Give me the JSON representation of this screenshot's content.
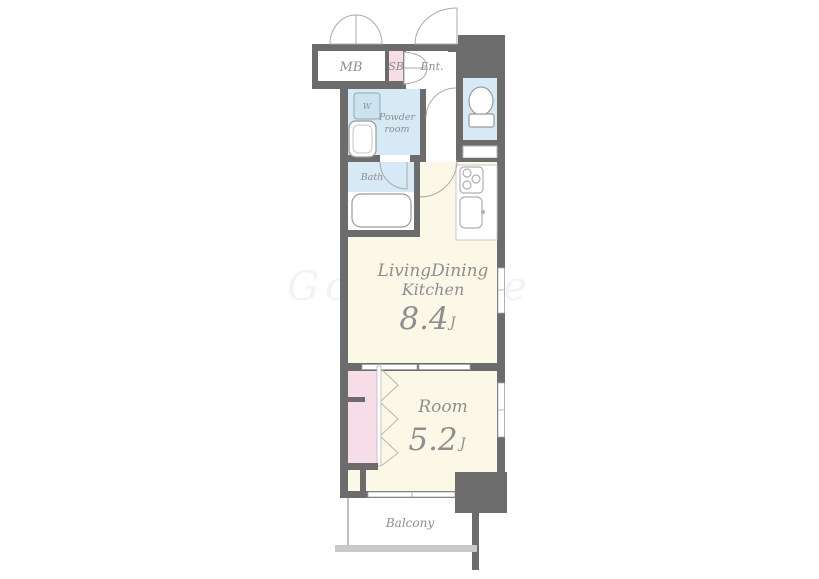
{
  "plan": {
    "rooms": {
      "mb": "MB",
      "sb": "SB",
      "entrance": "Ent.",
      "washer": "W",
      "powder_line1": "Powder",
      "powder_line2": "room",
      "bath": "Bath",
      "ldk_line1": "LivingDining",
      "ldk_line2": "Kitchen",
      "ldk_size": "8.4",
      "ldk_unit": "J",
      "room": "Room",
      "room_size": "5.2",
      "room_unit": "J",
      "balcony": "Balcony"
    },
    "watermark": "GooHoMe",
    "colors": {
      "wall": "#6c6c6c",
      "floor_cream": "#fbf8e8",
      "wet_area_blue": "#d6e9f4",
      "closet_pink": "#f7dde8",
      "outline_gray": "#9a9a9a",
      "label_gray": "#8f8f8f"
    }
  }
}
